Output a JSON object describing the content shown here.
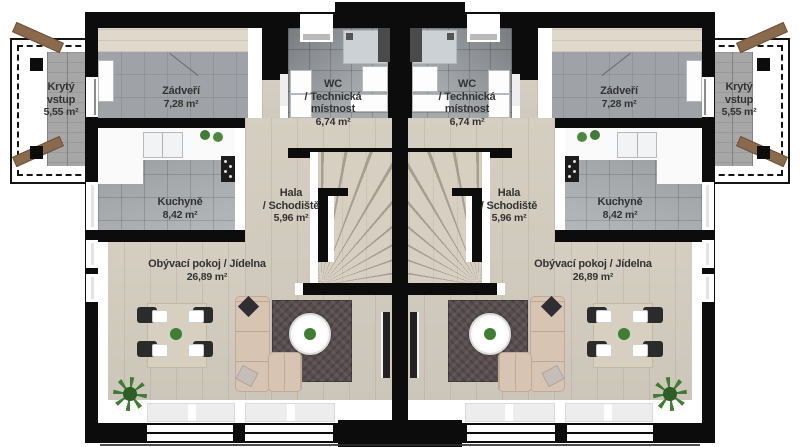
{
  "rooms": {
    "covered_entrance": {
      "line1": "Krytý",
      "line2": "vstup",
      "area": "5,55 m²"
    },
    "vestibule": {
      "name": "Zádveří",
      "area": "7,28 m²"
    },
    "wc_technical": {
      "line1": "WC",
      "line2": "/ Technická",
      "line3": "místnost",
      "area": "6,74 m²"
    },
    "kitchen": {
      "name": "Kuchyně",
      "area": "8,42 m²"
    },
    "hall_staircase": {
      "line1": "Hala",
      "line2": "/ Schodiště",
      "area": "5,96 m²"
    },
    "living_dining": {
      "name": "Obývací pokoj / Jídelna",
      "area": "26,89 m²"
    }
  },
  "colors": {
    "wall": "#0c0c0c",
    "wood_floor": "#d9d2c5",
    "tile_floor": "#9fa3a7",
    "rug": "#584d4f",
    "sofa": "#d8c4b2",
    "plant": "#3e7d33",
    "wood_beam": "#8a6a4c",
    "brick_path": "#a6a6a6",
    "label_text": "#333333"
  }
}
